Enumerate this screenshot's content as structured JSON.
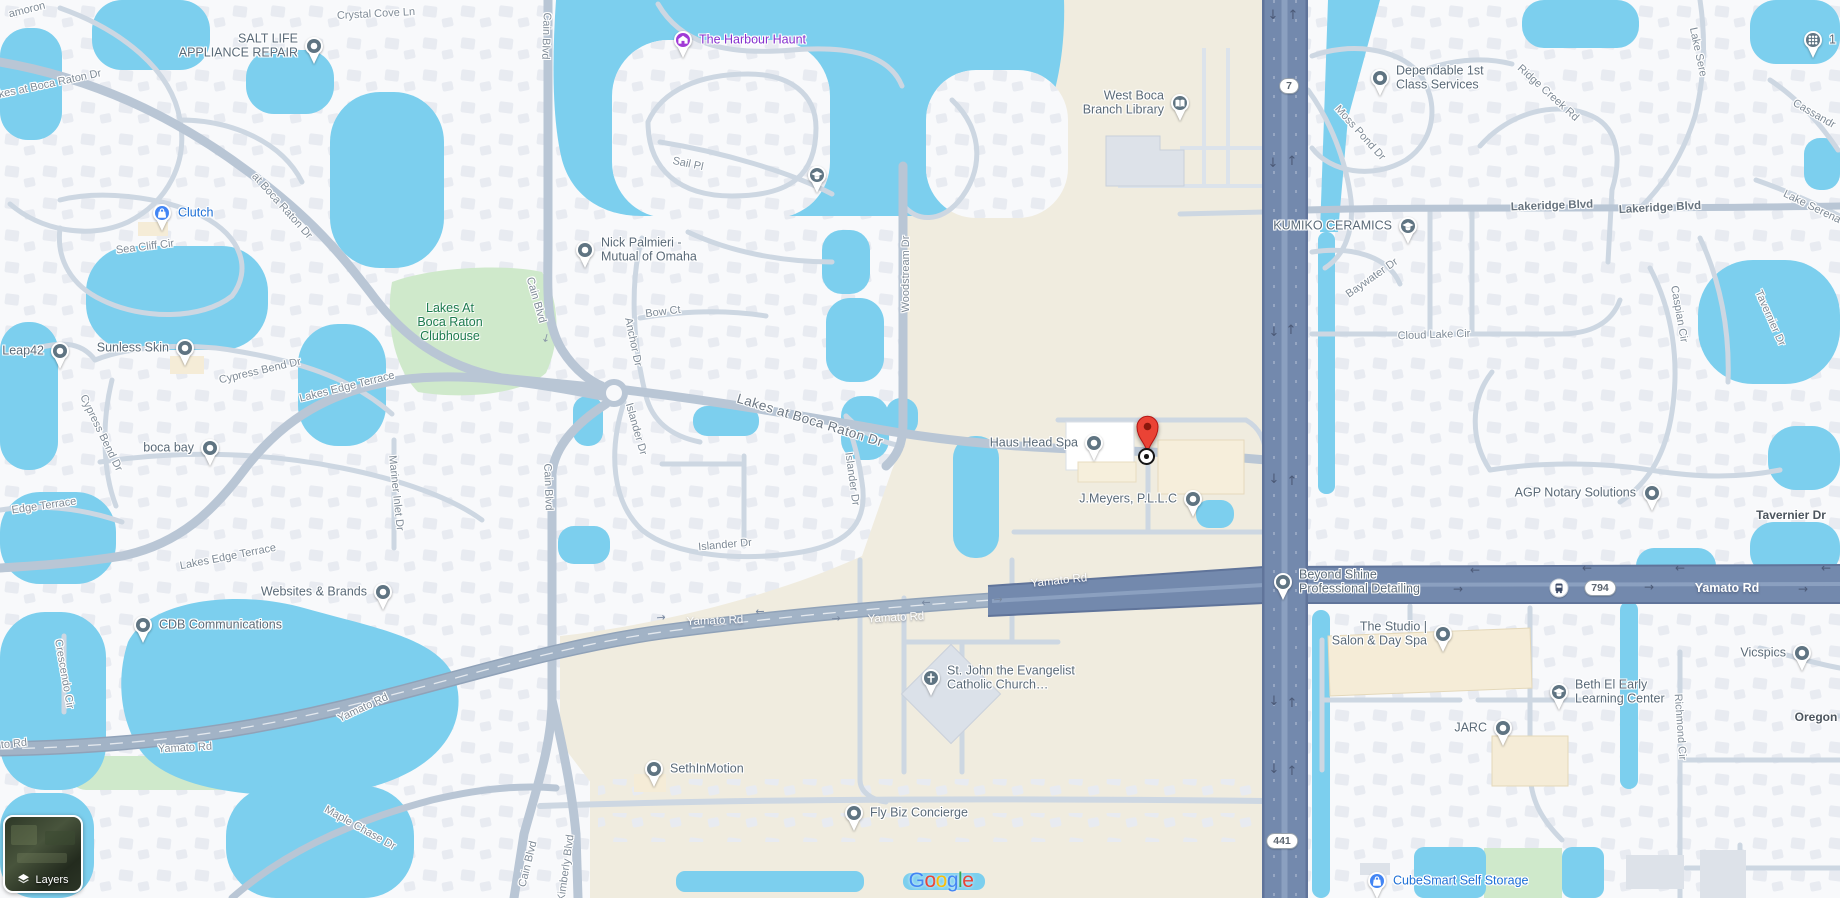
{
  "ui": {
    "layers_label": "Layers",
    "google_letters": [
      {
        "ch": "G",
        "color": "#4285F4"
      },
      {
        "ch": "o",
        "color": "#EA4335"
      },
      {
        "ch": "o",
        "color": "#FBBC05"
      },
      {
        "ch": "g",
        "color": "#4285F4"
      },
      {
        "ch": "l",
        "color": "#34A853"
      },
      {
        "ch": "e",
        "color": "#EA4335"
      }
    ],
    "google_logo_pos": {
      "x": 941,
      "y": 881
    }
  },
  "map": {
    "colors": {
      "water": "#7ccfee",
      "land_beige": "#f0ecdf",
      "residential": "#f8f9fb",
      "road_major": "#7389ad",
      "road_collector": "#b9c6d5",
      "road_minor": "#cdd7e2",
      "park": "#cfe9cb",
      "park_text": "#1e7b50",
      "poi_gray": "#5f7482",
      "poi_blue": "#4285f4",
      "poi_purple": "#a13ad6",
      "text_gray": "#5a6a78",
      "text_blue": "#1d6fd6",
      "text_purple": "#8430ce",
      "marker_red": "#EA4335"
    },
    "marker": {
      "x": 1147,
      "tip_y": 452,
      "target_y": 457
    },
    "bus_stop": {
      "x": 1559,
      "y": 588
    },
    "route_shields": [
      {
        "t": "7",
        "x": 1289,
        "y": 86
      },
      {
        "t": "794",
        "x": 1600,
        "y": 588
      },
      {
        "t": "441",
        "x": 1282,
        "y": 841
      }
    ],
    "area_labels": [
      {
        "slug": "lakes-at-boca-raton-clubhouse",
        "lines": [
          "Lakes At",
          "Boca Raton",
          "Clubhouse"
        ],
        "x": 450,
        "y": 322
      }
    ],
    "pois": [
      {
        "slug": "salt-life-appliance-repair",
        "lines": [
          "SALT LIFE",
          "APPLIANCE REPAIR"
        ],
        "x": 314,
        "y": 46,
        "side": "left",
        "glyph": "dot",
        "kind": "gray"
      },
      {
        "slug": "the-harbour-haunt",
        "lines": [
          "The Harbour Haunt"
        ],
        "x": 683,
        "y": 40,
        "side": "right",
        "glyph": "house",
        "kind": "purple"
      },
      {
        "slug": "west-boca-branch-library",
        "lines": [
          "West Boca",
          "Branch Library"
        ],
        "x": 1180,
        "y": 103,
        "side": "left",
        "glyph": "library",
        "kind": "gray"
      },
      {
        "slug": "dependable-1st-class-services",
        "lines": [
          "Dependable 1st",
          "Class Services"
        ],
        "x": 1380,
        "y": 78,
        "side": "right",
        "glyph": "dot",
        "kind": "gray"
      },
      {
        "slug": "clutch",
        "lines": [
          "Clutch"
        ],
        "x": 162,
        "y": 213,
        "side": "right",
        "glyph": "bag",
        "kind": "blue"
      },
      {
        "slug": "nick-palmieri-mutual-of-omaha",
        "lines": [
          "Nick Palmieri -",
          "Mutual of Omaha"
        ],
        "x": 585,
        "y": 250,
        "side": "right",
        "glyph": "dot",
        "kind": "gray"
      },
      {
        "slug": "school-poi",
        "lines": [],
        "x": 817,
        "y": 175,
        "side": "right",
        "glyph": "school",
        "kind": "gray"
      },
      {
        "slug": "kumiko-ceramics",
        "lines": [
          "KUMIKO CERAMICS"
        ],
        "x": 1408,
        "y": 226,
        "side": "left",
        "glyph": "school",
        "kind": "gray"
      },
      {
        "slug": "leap42",
        "lines": [
          "Leap42"
        ],
        "x": 60,
        "y": 351,
        "side": "left",
        "glyph": "dot",
        "kind": "gray"
      },
      {
        "slug": "sunless-skin",
        "lines": [
          "Sunless Skin"
        ],
        "x": 185,
        "y": 348,
        "side": "left",
        "glyph": "dot",
        "kind": "gray"
      },
      {
        "slug": "boca-bay",
        "lines": [
          "boca bay"
        ],
        "x": 210,
        "y": 448,
        "side": "left",
        "glyph": "dot",
        "kind": "gray"
      },
      {
        "slug": "websites-and-brands",
        "lines": [
          "Websites & Brands"
        ],
        "x": 383,
        "y": 592,
        "side": "left",
        "glyph": "dot",
        "kind": "gray"
      },
      {
        "slug": "cdb-communications",
        "lines": [
          "CDB Communications"
        ],
        "x": 143,
        "y": 625,
        "side": "right",
        "glyph": "dot",
        "kind": "gray"
      },
      {
        "slug": "haus-head-spa",
        "lines": [
          "Haus Head Spa"
        ],
        "x": 1094,
        "y": 443,
        "side": "left",
        "glyph": "dot",
        "kind": "gray"
      },
      {
        "slug": "j-meyers-pllc",
        "lines": [
          "J.Meyers, P.L.L.C"
        ],
        "x": 1193,
        "y": 499,
        "side": "left",
        "glyph": "dot",
        "kind": "gray"
      },
      {
        "slug": "beyond-shine-professional-detailing",
        "lines": [
          "Beyond Shine",
          "Professional Detailing"
        ],
        "x": 1283,
        "y": 582,
        "side": "right",
        "glyph": "dot",
        "kind": "gray"
      },
      {
        "slug": "agp-notary-solutions",
        "lines": [
          "AGP Notary Solutions"
        ],
        "x": 1652,
        "y": 493,
        "side": "left",
        "glyph": "dot",
        "kind": "gray"
      },
      {
        "slug": "the-studio-salon-day-spa",
        "lines": [
          "The Studio |",
          "Salon & Day Spa"
        ],
        "x": 1443,
        "y": 634,
        "side": "left",
        "glyph": "dot",
        "kind": "gray"
      },
      {
        "slug": "vicspics",
        "lines": [
          "Vicspics"
        ],
        "x": 1802,
        "y": 653,
        "side": "left",
        "glyph": "dot",
        "kind": "gray"
      },
      {
        "slug": "beth-el-early-learning-center",
        "lines": [
          "Beth El Early",
          "Learning Center"
        ],
        "x": 1559,
        "y": 692,
        "side": "right",
        "glyph": "school",
        "kind": "gray"
      },
      {
        "slug": "jarc",
        "lines": [
          "JARC"
        ],
        "x": 1503,
        "y": 728,
        "side": "left",
        "glyph": "dot",
        "kind": "gray"
      },
      {
        "slug": "st-john-the-evangelist",
        "lines": [
          "St. John the Evangelist",
          "Catholic Church…"
        ],
        "x": 931,
        "y": 678,
        "side": "right",
        "glyph": "church",
        "kind": "gray"
      },
      {
        "slug": "sethinmotion",
        "lines": [
          "SethInMotion"
        ],
        "x": 654,
        "y": 769,
        "side": "right",
        "glyph": "dot",
        "kind": "gray"
      },
      {
        "slug": "fly-biz-concierge",
        "lines": [
          "Fly Biz Concierge"
        ],
        "x": 854,
        "y": 813,
        "side": "right",
        "glyph": "dot",
        "kind": "gray"
      },
      {
        "slug": "cubesmart-self-storage",
        "lines": [
          "CubeSmart Self Storage"
        ],
        "x": 1377,
        "y": 881,
        "side": "right",
        "glyph": "bag",
        "kind": "blue"
      },
      {
        "slug": "apps-dots-poi",
        "lines": [
          "1"
        ],
        "x": 1813,
        "y": 40,
        "side": "right",
        "glyph": "dots",
        "kind": "gray"
      }
    ],
    "streets": [
      {
        "t": "amoron",
        "x": 27,
        "y": 10,
        "r": -14,
        "k": "m"
      },
      {
        "t": "Crystal Cove Ln",
        "x": 376,
        "y": 14,
        "r": -3,
        "k": "m"
      },
      {
        "t": "Cain Blvd",
        "x": 546,
        "y": 36,
        "r": 92,
        "k": "m"
      },
      {
        "t": "kes at Boca Raton Dr",
        "x": 50,
        "y": 84,
        "r": -12,
        "k": "m"
      },
      {
        "t": "Sail Pl",
        "x": 688,
        "y": 164,
        "r": 12,
        "k": "m"
      },
      {
        "t": "at Boca Raton Dr",
        "x": 282,
        "y": 206,
        "r": 48,
        "k": "m"
      },
      {
        "t": "Sea Cliff Cir",
        "x": 145,
        "y": 247,
        "r": -7,
        "k": "m"
      },
      {
        "t": "Woodstream Dr",
        "x": 906,
        "y": 274,
        "r": -90,
        "k": "m"
      },
      {
        "t": "Bow Ct",
        "x": 663,
        "y": 312,
        "r": -7,
        "k": "m"
      },
      {
        "t": "Anchor Dr",
        "x": 633,
        "y": 342,
        "r": 78,
        "k": "m"
      },
      {
        "t": "Cain Blvd",
        "x": 536,
        "y": 300,
        "r": 74,
        "k": "m"
      },
      {
        "t": "Moss Pond Dr",
        "x": 1360,
        "y": 133,
        "r": 48,
        "k": "m"
      },
      {
        "t": "Ridge Creek Rd",
        "x": 1548,
        "y": 93,
        "r": 42,
        "k": "m"
      },
      {
        "t": "Lake Sere",
        "x": 1698,
        "y": 52,
        "r": 78,
        "k": "m"
      },
      {
        "t": "Cassandr",
        "x": 1814,
        "y": 114,
        "r": 30,
        "k": "m"
      },
      {
        "t": "Lakeridge Blvd",
        "x": 1552,
        "y": 206,
        "r": -2,
        "k": "med"
      },
      {
        "t": "Lakeridge Blvd",
        "x": 1660,
        "y": 208,
        "r": -3,
        "k": "med"
      },
      {
        "t": "Lake Serena",
        "x": 1812,
        "y": 207,
        "r": 26,
        "k": "m"
      },
      {
        "t": "Baywater Dr",
        "x": 1372,
        "y": 278,
        "r": -35,
        "k": "m"
      },
      {
        "t": "Cloud Lake Cir",
        "x": 1434,
        "y": 335,
        "r": -2,
        "k": "m"
      },
      {
        "t": "Caspian Cir",
        "x": 1679,
        "y": 314,
        "r": 80,
        "k": "m"
      },
      {
        "t": "Tavernier Dr",
        "x": 1770,
        "y": 318,
        "r": 66,
        "k": "m"
      },
      {
        "t": "Cypress Bend Dr",
        "x": 260,
        "y": 371,
        "r": -13,
        "k": "m"
      },
      {
        "t": "Cypress Bend Dr",
        "x": 101,
        "y": 433,
        "r": 64,
        "k": "m"
      },
      {
        "t": "Lakes at Boca Raton Dr",
        "x": 810,
        "y": 420,
        "r": 17,
        "k": "big"
      },
      {
        "t": "Islander Dr",
        "x": 636,
        "y": 429,
        "r": 74,
        "k": "m"
      },
      {
        "t": "Islander Dr",
        "x": 852,
        "y": 479,
        "r": 82,
        "k": "m"
      },
      {
        "t": "Islander Dr",
        "x": 725,
        "y": 545,
        "r": -5,
        "k": "m"
      },
      {
        "t": "Mariner Inlet Dr",
        "x": 396,
        "y": 493,
        "r": 84,
        "k": "m"
      },
      {
        "t": "Lakes Edge Terrace",
        "x": 347,
        "y": 387,
        "r": -14,
        "k": "m"
      },
      {
        "t": "Edge Terrace",
        "x": 44,
        "y": 506,
        "r": -8,
        "k": "m"
      },
      {
        "t": "Lakes Edge Terrace",
        "x": 228,
        "y": 557,
        "r": -11,
        "k": "m"
      },
      {
        "t": "Cain Blvd",
        "x": 548,
        "y": 487,
        "r": 88,
        "k": "m"
      },
      {
        "t": "Crescendo Cir",
        "x": 64,
        "y": 674,
        "r": 80,
        "k": "m"
      },
      {
        "t": "Yamato Rd",
        "x": 715,
        "y": 621,
        "r": -2,
        "k": "w"
      },
      {
        "t": "Yamato Rd",
        "x": 896,
        "y": 618,
        "r": -3,
        "k": "w"
      },
      {
        "t": "Yamato Rd",
        "x": 1059,
        "y": 581,
        "r": -6,
        "k": "w"
      },
      {
        "t": "Yamato Rd",
        "x": 1727,
        "y": 588,
        "r": 0,
        "k": "wb"
      },
      {
        "t": "Yamato Rd",
        "x": 363,
        "y": 708,
        "r": -25,
        "k": "m"
      },
      {
        "t": "Yamato Rd",
        "x": 185,
        "y": 748,
        "r": -3,
        "k": "m"
      },
      {
        "t": "to Rd",
        "x": 14,
        "y": 744,
        "r": -6,
        "k": "m"
      },
      {
        "t": "Tavernier Dr",
        "x": 1791,
        "y": 515,
        "r": 0,
        "k": "bold"
      },
      {
        "t": "Oregon R",
        "x": 1822,
        "y": 717,
        "r": 0,
        "k": "bold"
      },
      {
        "t": "Richmond Cir",
        "x": 1680,
        "y": 727,
        "r": 86,
        "k": "m"
      },
      {
        "t": "Maple Chase Dr",
        "x": 360,
        "y": 828,
        "r": 29,
        "k": "m"
      },
      {
        "t": "Cain Blvd",
        "x": 528,
        "y": 864,
        "r": -76,
        "k": "m"
      },
      {
        "t": "Kimberly Blvd",
        "x": 566,
        "y": 868,
        "r": -82,
        "k": "m"
      }
    ]
  }
}
